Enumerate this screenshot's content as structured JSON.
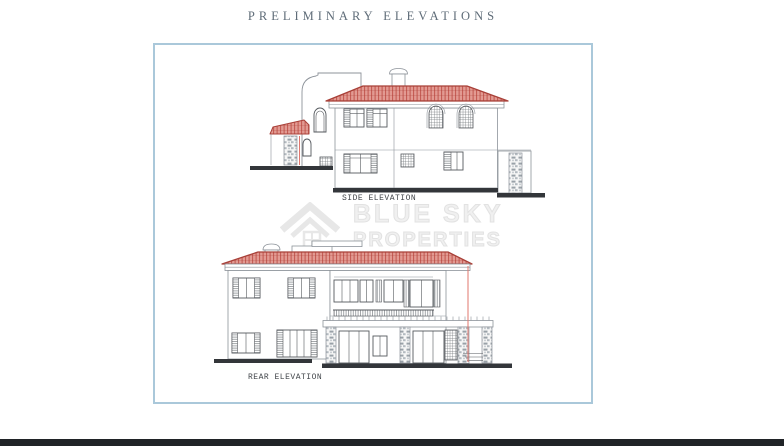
{
  "title": "PRELIMINARY ELEVATIONS",
  "sheet": {
    "side_elevation_label": "SIDE ELEVATION",
    "rear_elevation_label": "REAR ELEVATION"
  },
  "watermark": {
    "line1": "BLUE SKY",
    "line2": "PROPERTIES",
    "icon": "house-logo"
  },
  "colors": {
    "border": "#aac8da",
    "roof_fill": "#e29a92",
    "roof_stripe": "#c2564e",
    "roof_ridge": "#a84038",
    "wall_line": "#8d939a",
    "dark_line": "#55595e",
    "ground": "#33363a",
    "red_line": "#e0776e",
    "title_color": "#5f6c78",
    "label_color": "#42464b",
    "watermark_color": "#f0f0f0",
    "bottom_bar": "#202327"
  }
}
